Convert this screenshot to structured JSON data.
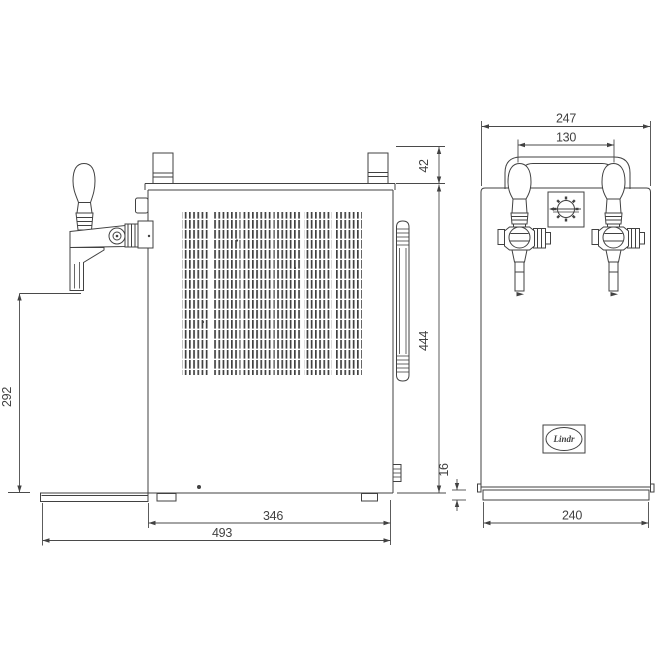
{
  "drawing": {
    "subject": "two-tap beer cooler dimensional drawing",
    "line_color": "#414141",
    "background_color": "#ffffff"
  },
  "side_view": {
    "dim_spout_height": "292",
    "dim_top_fitting_height": "42",
    "dim_body_height": "444",
    "dim_body_depth": "346",
    "dim_total_depth": "493"
  },
  "front_view": {
    "dim_width": "247",
    "dim_handle_spacing": "130",
    "dim_base_height": "16",
    "dim_base_width": "240",
    "logo_text": "Lindr"
  }
}
